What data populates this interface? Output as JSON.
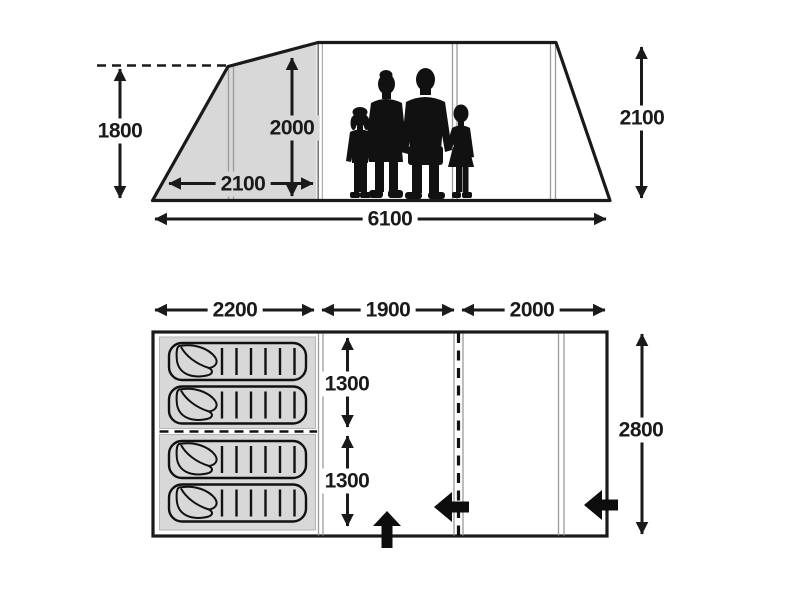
{
  "diagram": {
    "title": "tent-dimension-diagram",
    "colors": {
      "ink": "#1a1a1a",
      "shade": "#d8d8d8",
      "thin_line": "#9a9a9a"
    },
    "side_view": {
      "porch_peak_height": "1800",
      "inner_height": "2000",
      "porch_depth": "2100",
      "ridge_height": "2100",
      "total_length": "6100"
    },
    "floor_plan": {
      "bedroom_width": "2200",
      "middle_width": "1900",
      "front_width": "2000",
      "upper_bed_length": "1300",
      "lower_bed_length": "1300",
      "overall_depth": "2800",
      "sleeping_bag_count": "4",
      "entrance_arrows": [
        "front-bottom-up",
        "middle-door-left",
        "right-side-left"
      ]
    }
  }
}
